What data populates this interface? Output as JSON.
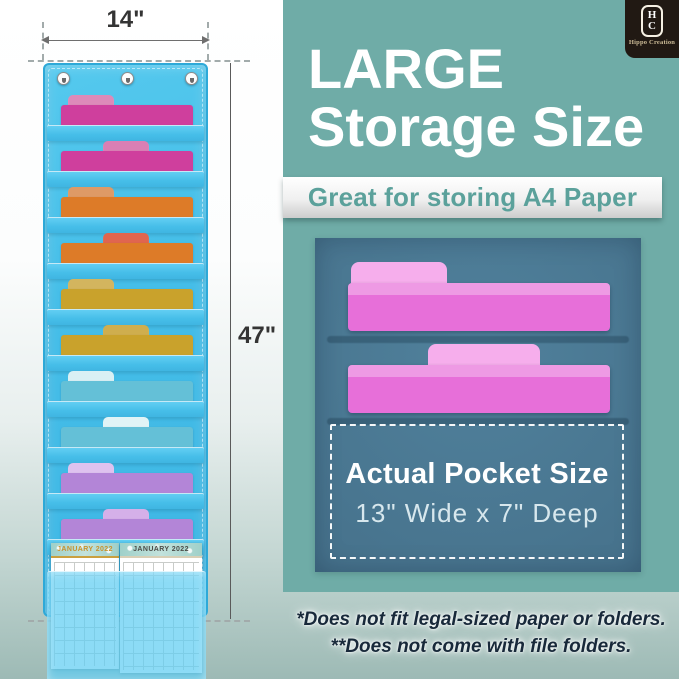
{
  "dimensions": {
    "width_label": "14\"",
    "height_label": "47\""
  },
  "organizer": {
    "fabric_color": "#45bee8",
    "grommet_count": 3,
    "folders": [
      {
        "name": "pink-left",
        "body": "#cf3f9d",
        "tab": "#dd8ab9",
        "tab_pos": "left"
      },
      {
        "name": "pink-center",
        "body": "#cf3f9d",
        "tab": "#db7fb4",
        "tab_pos": "center"
      },
      {
        "name": "orange-left",
        "body": "#dd7b28",
        "tab": "#de9a66",
        "tab_pos": "left"
      },
      {
        "name": "orange-center",
        "body": "#dd7b28",
        "tab": "#e0654f",
        "tab_pos": "center"
      },
      {
        "name": "gold-left",
        "body": "#c9a22c",
        "tab": "#d3b55e",
        "tab_pos": "left"
      },
      {
        "name": "gold-center",
        "body": "#c9a22c",
        "tab": "#cfae4e",
        "tab_pos": "center"
      },
      {
        "name": "cyan-left",
        "body": "#64c0d7",
        "tab": "#daf0f4",
        "tab_pos": "left"
      },
      {
        "name": "cyan-center",
        "body": "#64c0d7",
        "tab": "#e0f3f6",
        "tab_pos": "center"
      },
      {
        "name": "purple-left",
        "body": "#b385d7",
        "tab": "#dec2ef",
        "tab_pos": "left"
      },
      {
        "name": "purple-center",
        "body": "#b385d7",
        "tab": "#d5b0e9",
        "tab_pos": "center"
      }
    ],
    "calendar": {
      "left_month": "JANUARY 2022",
      "right_month": "JANUARY 2022"
    }
  },
  "panel": {
    "bg": "#6faca7",
    "logo": {
      "initial_top": "H",
      "initial_bottom": "C",
      "brand": "Hippo Creation"
    },
    "heading_line1": "LARGE",
    "heading_line2": "Storage Size",
    "banner_text": "Great for storing A4 Paper",
    "inset": {
      "bg": "#4a7690",
      "folder_body": "#e76fd9",
      "folder_tab": "#f6aeec",
      "title": "Actual Pocket Size",
      "subtitle": "13\" Wide x 7\" Deep"
    },
    "footnote_line1": "*Does not fit legal-sized paper or folders.",
    "footnote_line2": "**Does not come with file folders."
  }
}
